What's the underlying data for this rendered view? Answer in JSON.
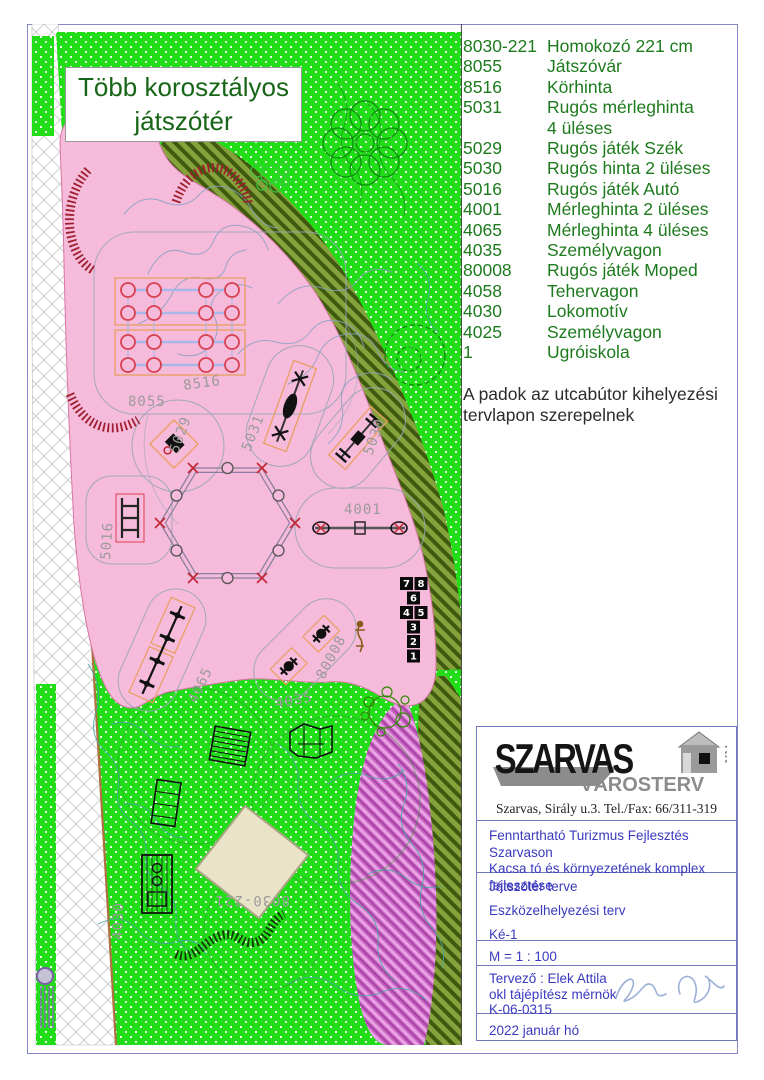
{
  "plan": {
    "title": "Több korosztályos\njátszótér"
  },
  "legend": {
    "rows": [
      {
        "code": "8030-221",
        "name": "Homokozó 221 cm"
      },
      {
        "code": "8055",
        "name": "Játszóvár"
      },
      {
        "code": "8516",
        "name": "Körhinta"
      },
      {
        "code": "5031",
        "name": "Rugós mérleghinta\n4 üléses"
      },
      {
        "code": "5029",
        "name": "Rugós játék Szék"
      },
      {
        "code": "5030",
        "name": "Rugós hinta 2 üléses"
      },
      {
        "code": "5016",
        "name": "Rugós játék Autó"
      },
      {
        "code": "4001",
        "name": "Mérleghinta 2 üléses"
      },
      {
        "code": "4065",
        "name": "Mérleghinta 4 üléses"
      },
      {
        "code": "4035",
        "name": "Személyvagon"
      },
      {
        "code": "80008",
        "name": "Rugós játék Moped"
      },
      {
        "code": "4058",
        "name": "Tehervagon"
      },
      {
        "code": "4030",
        "name": "Lokomotív"
      },
      {
        "code": "4025",
        "name": "Személyvagon"
      },
      {
        "code": "1",
        "name": "Ugróiskola"
      }
    ],
    "note": "A padok az utcabútor kihelyezési tervlapon szerepelnek"
  },
  "map": {
    "labels": [
      {
        "text": "8055"
      },
      {
        "text": "8516"
      },
      {
        "text": "5029"
      },
      {
        "text": "5031"
      },
      {
        "text": "5030"
      },
      {
        "text": "5016"
      },
      {
        "text": "4001"
      },
      {
        "text": "4065"
      },
      {
        "text": "80008"
      },
      {
        "text": "4035"
      },
      {
        "text": "4030"
      },
      {
        "text": "8030-221"
      }
    ],
    "hopscotch": [
      "7",
      "8",
      "6",
      "4",
      "5",
      "3",
      "2",
      "1"
    ]
  },
  "title_block": {
    "company": {
      "name": "SZARVAS",
      "sub": "VÁROSTERV",
      "suffix": "Kft",
      "address": "Szarvas, Sirály u.3. Tel./Fax: 66/311-319"
    },
    "project": "Fenntartható Turizmus Fejlesztés Szarvason\nKacsa tó és környezetének komplex\nfejlesztése",
    "doc1": "Játszótér terve",
    "doc2": "Eszközelhelyezési terv",
    "doc3": "Ké-1",
    "scale": "M = 1 : 100",
    "designer": "Tervező : Elek Attila",
    "designer_title": "okl tájépítész mérnök",
    "designer_id": "K-06-0315",
    "date": "2022 január hó"
  },
  "colors": {
    "lawn_green": "#21de18",
    "playground_pink": "#f6bada",
    "shrub_olive": "#7e9c35",
    "path_magenta": "#cb6fc8",
    "legend_green": "#1d7a1d",
    "titleblock_blue": "#3a3abf",
    "border_purple": "#8486c8"
  }
}
